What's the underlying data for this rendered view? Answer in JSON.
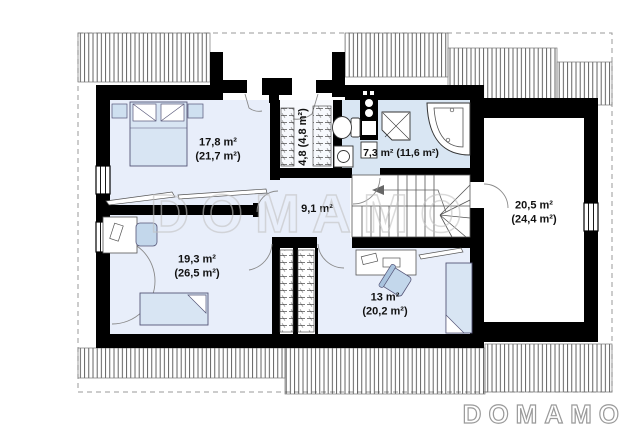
{
  "watermark_text": "DOMAMO",
  "logo_text": "DOMAMO",
  "rooms": {
    "bedroom": {
      "line1": "17,8 m²",
      "line2": "(21,7 m²)"
    },
    "wardrobe": {
      "label": "4,8 (4,8 m²)"
    },
    "bathroom": {
      "label": "7,3 m² (11,6 m²)"
    },
    "hall": {
      "label": "9,1 m²"
    },
    "room_left_bottom": {
      "line1": "19,3 m²",
      "line2": "(26,5 m²)"
    },
    "room_right_bottom": {
      "line1": "13 m²",
      "line2": "(20,2 m²)"
    },
    "room_over_garage": {
      "line1": "20,5 m²",
      "line2": "(24,4 m²)"
    }
  },
  "colors": {
    "wall": "#000000",
    "floor": "#e8eefa",
    "bathroom_floor": "#d9e6f3",
    "furniture": "#d8e5f3",
    "chair": "#c3d7eb",
    "watermark": "#c2c2c2"
  }
}
